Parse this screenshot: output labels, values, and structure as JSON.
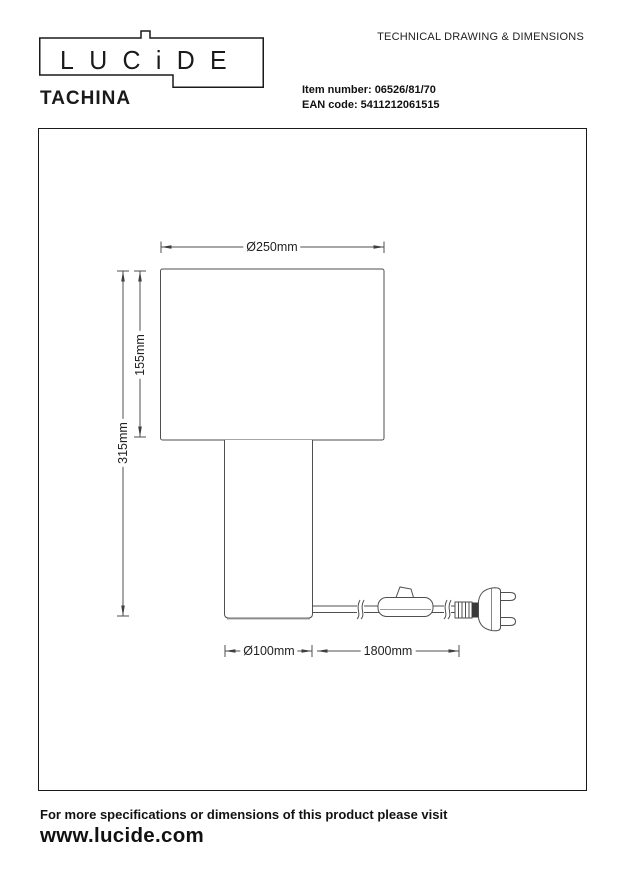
{
  "header": {
    "logo_text": "LUCiDE",
    "doc_title": "TECHNICAL DRAWING & DIMENSIONS",
    "product_name": "TACHINA",
    "item_number_label": "Item number:",
    "item_number_value": "06526/81/70",
    "ean_label": "EAN code:",
    "ean_value": "5411212061515"
  },
  "drawing": {
    "dimensions": {
      "shade_diameter": "Ø250mm",
      "shade_height": "155mm",
      "total_height": "315mm",
      "base_diameter": "Ø100mm",
      "cable_length": "1800mm"
    }
  },
  "footer": {
    "note": "For more specifications or dimensions of this product please visit",
    "website": "www.lucide.com"
  },
  "colors": {
    "line": "#4f4f4f",
    "text": "#1a1a1a",
    "background": "#ffffff"
  }
}
